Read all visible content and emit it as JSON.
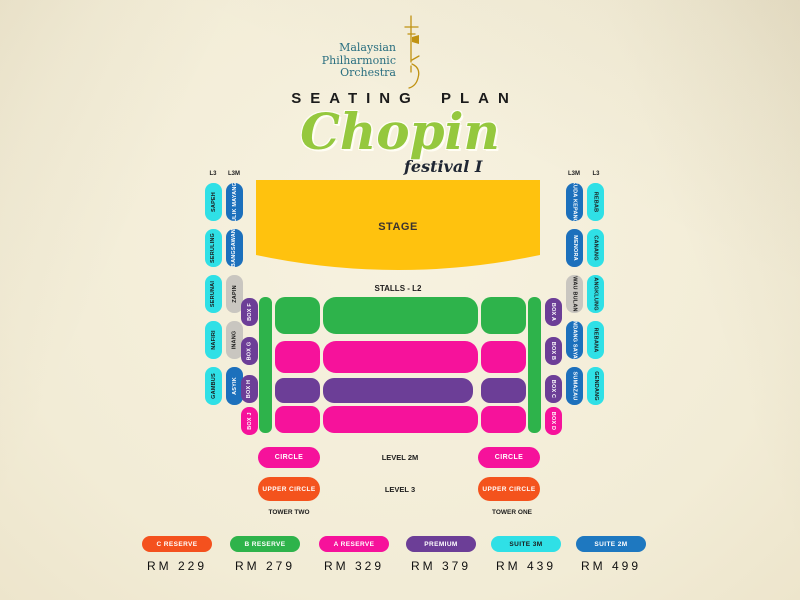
{
  "header": {
    "logo": {
      "lines": [
        "Malaysian",
        "Philharmonic",
        "Orchestra"
      ]
    },
    "title": "SEATING PLAN",
    "event": {
      "name": "Chopin",
      "edition": "festival I"
    }
  },
  "colors": {
    "background": "#F2ECD6",
    "stage_yellow": "#FFC20E",
    "green": "#2EB34B",
    "pink": "#F6129B",
    "purple": "#6C3E97",
    "cyan": "#2FE0E6",
    "blue": "#1C70BC",
    "gray": "#C9C6C0",
    "orange": "#F4531D",
    "logo_teal": "#2A6F80",
    "chopin_green": "#95C83E"
  },
  "seatmap": {
    "stage_label": "STAGE",
    "stalls_label": "STALLS - L2",
    "left": {
      "headers": [
        "L3",
        "L3M"
      ],
      "l3_suites": [
        {
          "label": "SAPEH",
          "color": "#2FE0E6"
        },
        {
          "label": "SERULING",
          "color": "#2FE0E6"
        },
        {
          "label": "SERUNAI",
          "color": "#2FE0E6"
        },
        {
          "label": "NAFIRI",
          "color": "#2FE0E6"
        },
        {
          "label": "GAMBUS",
          "color": "#2FE0E6"
        }
      ],
      "l3m_suites": [
        {
          "label": "ULIK MAYANG",
          "color": "#1C70BC"
        },
        {
          "label": "BANGSAWAN",
          "color": "#1C70BC"
        },
        {
          "label": "ZAPIN",
          "color": "#C9C6C0"
        },
        {
          "label": "INANG",
          "color": "#C9C6C0"
        },
        {
          "label": "ASYIK",
          "color": "#1C70BC"
        }
      ],
      "boxes": [
        {
          "label": "BOX F",
          "color": "#6C3E97"
        },
        {
          "label": "BOX G",
          "color": "#6C3E97"
        },
        {
          "label": "BOX H",
          "color": "#6C3E97"
        },
        {
          "label": "BOX J",
          "color": "#F6129B"
        }
      ]
    },
    "right": {
      "headers": [
        "L3M",
        "L3"
      ],
      "l3m_suites": [
        {
          "label": "KUDA KEPANG",
          "color": "#1C70BC"
        },
        {
          "label": "MENORA",
          "color": "#1C70BC"
        },
        {
          "label": "WAU BULAN",
          "color": "#C9C6C0"
        },
        {
          "label": "DONDANG SAYANG",
          "color": "#1C70BC"
        },
        {
          "label": "SUMAZAU",
          "color": "#1C70BC"
        }
      ],
      "l3_suites": [
        {
          "label": "REBAB",
          "color": "#2FE0E6"
        },
        {
          "label": "CANANG",
          "color": "#2FE0E6"
        },
        {
          "label": "ANGKLUNG",
          "color": "#2FE0E6"
        },
        {
          "label": "REBANA",
          "color": "#2FE0E6"
        },
        {
          "label": "GENDANG",
          "color": "#2FE0E6"
        }
      ],
      "boxes": [
        {
          "label": "BOX A",
          "color": "#6C3E97"
        },
        {
          "label": "BOX B",
          "color": "#6C3E97"
        },
        {
          "label": "BOX C",
          "color": "#6C3E97"
        },
        {
          "label": "BOX D",
          "color": "#F6129B"
        }
      ]
    },
    "lower": {
      "circle": "CIRCLE",
      "upper_circle": "UPPER CIRCLE",
      "level_2m": "LEVEL 2M",
      "level_3": "LEVEL 3",
      "tower_two": "TOWER TWO",
      "tower_one": "TOWER ONE"
    }
  },
  "legend": [
    {
      "label": "C RESERVE",
      "price": "RM 229",
      "color": "#F4511E"
    },
    {
      "label": "B RESERVE",
      "price": "RM 279",
      "color": "#2EB34B"
    },
    {
      "label": "A RESERVE",
      "price": "RM 329",
      "color": "#F6129B"
    },
    {
      "label": "PREMIUM",
      "price": "RM 379",
      "color": "#6C3E97"
    },
    {
      "label": "SUITE 3M",
      "price": "RM 439",
      "color": "#2FE0E6"
    },
    {
      "label": "SUITE 2M",
      "price": "RM 499",
      "color": "#1E78C0"
    }
  ]
}
